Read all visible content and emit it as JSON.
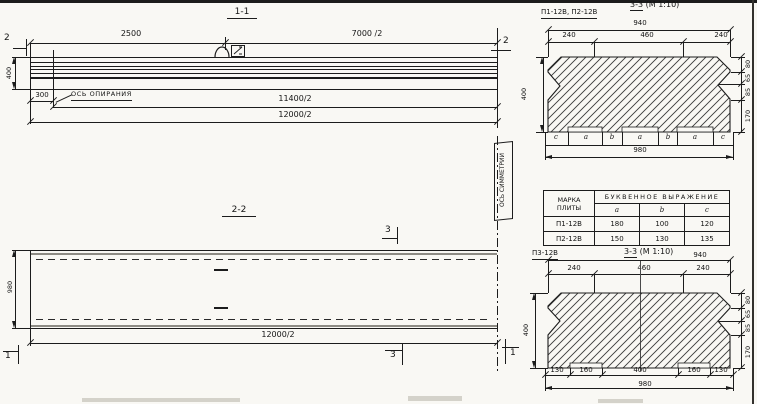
{
  "s11": {
    "title": "1-1",
    "d2500": "2500",
    "d7000": "7000 /2",
    "d400": "400",
    "d300": "300",
    "axis": "ОСЬ ОПИРАНИЯ",
    "d11400": "11400/2",
    "d12000": "12000/2",
    "mark_left": "2",
    "mark_right": "2"
  },
  "s22": {
    "title": "2-2",
    "d980": "980",
    "d12000": "12000/2",
    "symmetry": "ОСЬ СИММЕТРИИ",
    "mark3_top": "3",
    "mark3_bottom": "3",
    "mark1_left": "1",
    "mark1_right": "1"
  },
  "s33t": {
    "label": "П1-12В, П2-12В",
    "title_cut": "3-3",
    "title_scale": "(М 1:10)",
    "d940": "940",
    "top": [
      "240",
      "460",
      "240"
    ],
    "d400": "400",
    "right": [
      "80",
      "65",
      "85",
      "170"
    ],
    "letters": [
      "c",
      "a",
      "b",
      "a",
      "b",
      "a",
      "c"
    ],
    "d980": "980"
  },
  "table": {
    "h_mark1": "МАРКА",
    "h_mark2": "ПЛИТЫ",
    "h_expr": "БУКВЕННОЕ ВЫРАЖЕНИЕ",
    "cols": [
      "a",
      "b",
      "c"
    ],
    "rows": [
      [
        "П1-12В",
        "180",
        "100",
        "120"
      ],
      [
        "П2-12В",
        "150",
        "130",
        "135"
      ]
    ]
  },
  "s33b": {
    "label": "П3-12В",
    "title_cut": "3-3",
    "title_scale": "(М 1:10)",
    "d940": "940",
    "top": [
      "240",
      "460",
      "240"
    ],
    "d400": "400",
    "right": [
      "80",
      "65",
      "85",
      "170"
    ],
    "bottom": [
      "130",
      "160",
      "400",
      "160",
      "130"
    ],
    "d980": "980"
  }
}
